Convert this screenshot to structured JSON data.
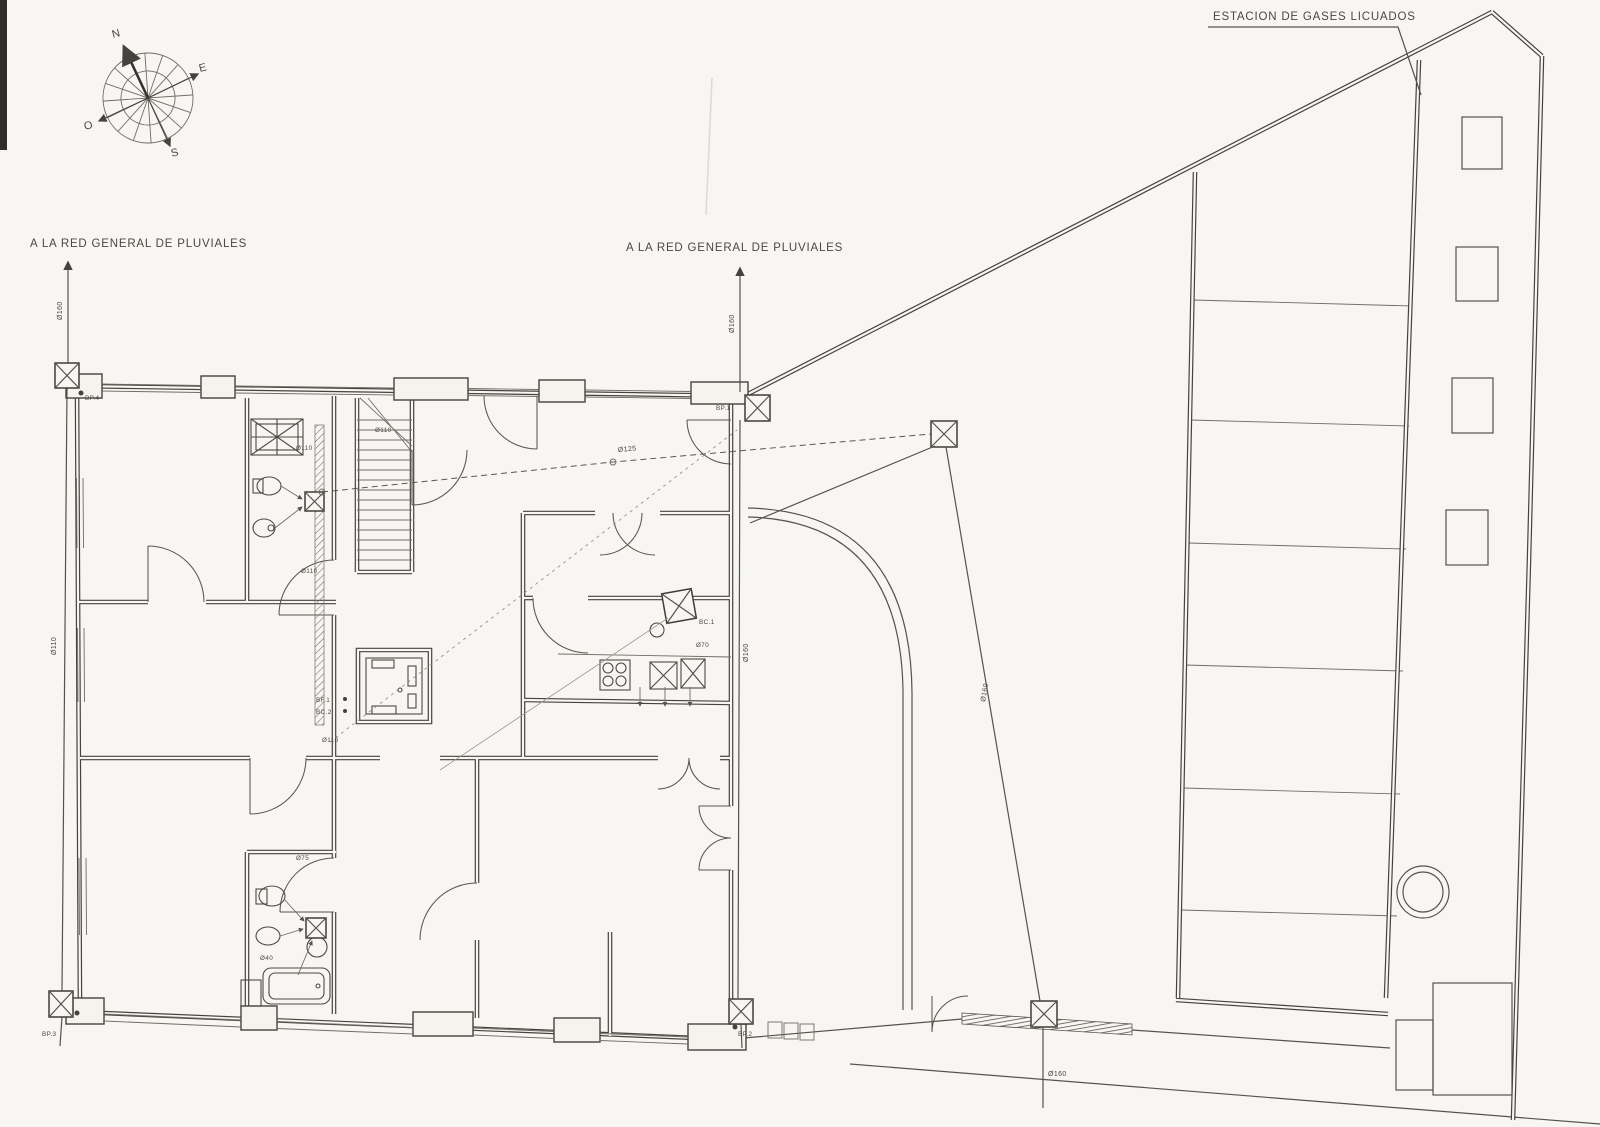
{
  "meta": {
    "paper_color": "#f7f6f2",
    "ink_color": "#45433e",
    "drawing_type": "site / sanitation plan"
  },
  "labels": {
    "pluviales_left": "A LA RED GENERAL DE PLUVIALES",
    "pluviales_center": "A LA RED GENERAL DE PLUVIALES",
    "estacion": "ESTACION DE GASES LICUADOS"
  },
  "compass": {
    "n": "N",
    "e": "E",
    "s": "S",
    "o": "O"
  },
  "manholes": {
    "bp4": "BP.4",
    "bp3": "BP.3",
    "bp1": "BP.1",
    "bp2": "BP.2",
    "bc1": "BC.1",
    "bf1": "BF.1",
    "bc2": "BC.2"
  },
  "pipes": {
    "d160_left": "Ø160",
    "d110_left": "Ø110",
    "d160_center": "Ø160",
    "d160_center_low": "Ø160",
    "d125_collector": "Ø125",
    "d160_court": "Ø160",
    "d160_outfall": "Ø160",
    "d110_stair": "Ø110",
    "d110_bath1": "Ø110",
    "d110_channel": "Ø110",
    "d110_utility": "Ø110",
    "d70_kitchen": "Ø70",
    "d75_bath2": "Ø75",
    "d40_bath2": "Ø40"
  }
}
